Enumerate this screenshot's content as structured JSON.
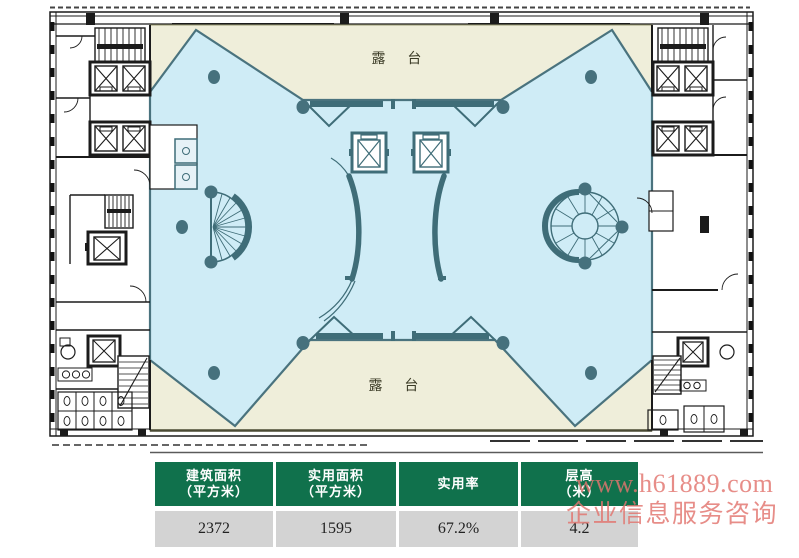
{
  "floor_plan": {
    "terrace_top_label": "露 台",
    "terrace_bottom_label": "露 台"
  },
  "info_table": {
    "headers": [
      {
        "line1": "建筑面积",
        "line2": "（平方米）"
      },
      {
        "line1": "实用面积",
        "line2": "（平方米）"
      },
      {
        "line1": "实用率",
        "line2": ""
      },
      {
        "line1": "层高",
        "line2": "（米）"
      }
    ],
    "values": [
      "2372",
      "1595",
      "67.2%",
      "4.2"
    ]
  },
  "watermark": {
    "line1": "www.h61889.com",
    "line2": "企业信息服务咨询"
  },
  "colors": {
    "hall_fill": "#cfecf6",
    "hall_edge": "#4a737e",
    "terrace_fill": "#efeeda",
    "fixture_teal": "#3f6d78",
    "wall": "#1b1b1b",
    "table_header_bg": "#10714c",
    "table_row_bg": "#d3d3d3",
    "watermark_color": "#e2756f"
  }
}
